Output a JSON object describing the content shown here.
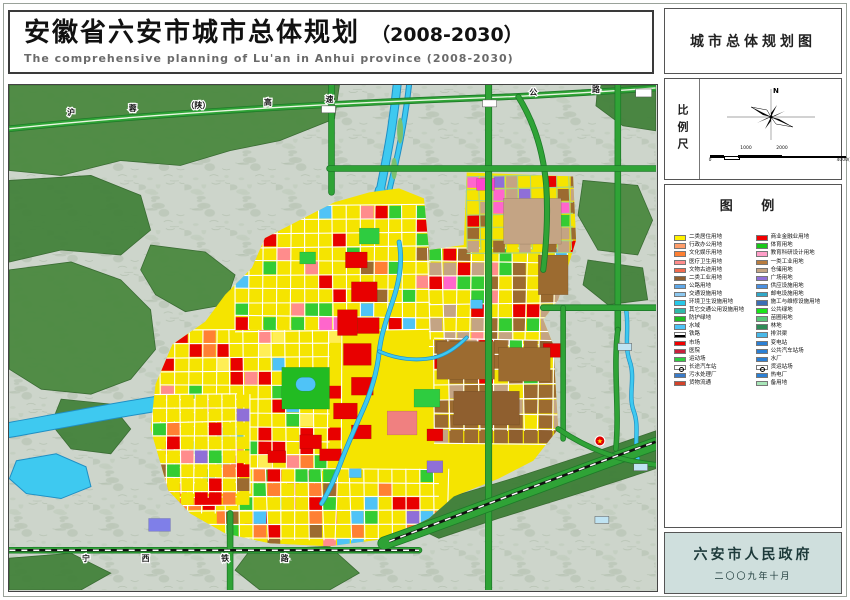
{
  "title": {
    "zh": "安徽省六安市城市总体规划",
    "year": "（2008-2030）",
    "en": "The comprehensive planning of Lu'an in Anhui province (2008-2030)"
  },
  "sidebar": {
    "map_title": "城市总体规划图",
    "scale_label": "比例尺",
    "north_label": "N",
    "legend_title": "图  例",
    "footer": {
      "org": "六安市人民政府",
      "date": "二〇〇九年十月"
    }
  },
  "scalebar": {
    "ticks": [
      {
        "label": "0",
        "pos": 0,
        "below": true
      },
      {
        "label": "1000",
        "pos": 36,
        "below": false
      },
      {
        "label": "2000",
        "pos": 72,
        "below": false
      },
      {
        "label": "4000(M)",
        "pos": 136,
        "below": true
      }
    ]
  },
  "legend": {
    "left": [
      {
        "label": "二类居住用地",
        "color": "#FFF200"
      },
      {
        "label": "行政办公用地",
        "color": "#FF9E6B"
      },
      {
        "label": "文化娱乐用地",
        "color": "#FF8033"
      },
      {
        "label": "医疗卫生用地",
        "color": "#FF8C8C"
      },
      {
        "label": "文物古迹用地",
        "color": "#F26B4E"
      },
      {
        "label": "二类工业用地",
        "color": "#8F5F2F"
      },
      {
        "label": "公路用地",
        "color": "#5FA8E8"
      },
      {
        "label": "交通设施用地",
        "color": "#8CC8F0"
      },
      {
        "label": "环境卫生设施用地",
        "color": "#28C8E8"
      },
      {
        "label": "其它交通公用设施用地",
        "color": "#30B8A8"
      },
      {
        "label": "防护绿地",
        "color": "#22BB22"
      },
      {
        "label": "水域",
        "color": "#4FC3F7"
      },
      {
        "label": "铁路",
        "color": "#FFFFFF",
        "type": "line"
      },
      {
        "label": "市场",
        "color": "#F20000"
      },
      {
        "label": "医院",
        "color": "#C81E3C"
      },
      {
        "label": "运动场",
        "color": "#2ECC40"
      },
      {
        "label": "长途汽车站",
        "color": "#FFFFFF",
        "type": "circle"
      },
      {
        "label": "污水处理厂",
        "color": "#3A7BC8"
      },
      {
        "label": "货物流通",
        "color": "#D2422A"
      }
    ],
    "right": [
      {
        "label": "商业金融业用地",
        "color": "#F20000"
      },
      {
        "label": "体育用地",
        "color": "#19C819"
      },
      {
        "label": "教育科研设计用地",
        "color": "#FF9EC8"
      },
      {
        "label": "一类工业用地",
        "color": "#B97C3E"
      },
      {
        "label": "仓储用地",
        "color": "#C4A484"
      },
      {
        "label": "广场用地",
        "color": "#8F6FD8"
      },
      {
        "label": "供应设施用地",
        "color": "#4A90E2"
      },
      {
        "label": "邮电设施用地",
        "color": "#30A8C8"
      },
      {
        "label": "施工与维修设施用地",
        "color": "#3C6EB4"
      },
      {
        "label": "公共绿地",
        "color": "#19E619"
      },
      {
        "label": "苗圃用地",
        "color": "#58C878"
      },
      {
        "label": "林地",
        "color": "#2E8B57"
      },
      {
        "label": "排洪渠",
        "color": "#49B8E8"
      },
      {
        "label": "变电站",
        "color": "#2B7FD4"
      },
      {
        "label": "公共汽车站场",
        "color": "#2B7FD4"
      },
      {
        "label": "水厂",
        "color": "#2B7FD4"
      },
      {
        "label": "货运站场",
        "color": "#FFFFFF",
        "type": "circle"
      },
      {
        "label": "热电厂",
        "color": "#2B7FD4"
      },
      {
        "label": "备用地",
        "color": "#A8E6B8"
      }
    ]
  },
  "map": {
    "bg": "#cdd5cb",
    "road_labels": [
      {
        "t": "沪",
        "x": 70,
        "y": 114
      },
      {
        "t": "蓉",
        "x": 132,
        "y": 110
      },
      {
        "t": "（陕）",
        "x": 198,
        "y": 107
      },
      {
        "t": "高",
        "x": 268,
        "y": 104
      },
      {
        "t": "速",
        "x": 330,
        "y": 101
      },
      {
        "t": "公",
        "x": 535,
        "y": 94
      },
      {
        "t": "路",
        "x": 598,
        "y": 91
      },
      {
        "t": "宁",
        "x": 85,
        "y": 563
      },
      {
        "t": "西",
        "x": 145,
        "y": 563
      },
      {
        "t": "铁",
        "x": 225,
        "y": 563
      },
      {
        "t": "路",
        "x": 285,
        "y": 563
      }
    ],
    "forests": [
      {
        "pts": "8,84 340,84 335,118 280,140 230,150 180,165 120,160 60,175 8,170",
        "fill": "#4c8a41"
      },
      {
        "pts": "8,180 90,175 140,195 150,230 120,255 60,250 8,262",
        "fill": "#45833d"
      },
      {
        "pts": "8,270 70,262 120,280 150,310 155,350 130,380 90,395 40,390 8,370",
        "fill": "#4c8a41"
      },
      {
        "pts": "60,400 110,405 130,430 110,455 70,450 50,425",
        "fill": "#45833d"
      },
      {
        "pts": "150,245 205,252 235,275 225,305 185,312 155,295 140,270",
        "fill": "#4c8a41"
      },
      {
        "pts": "600,84 658,84 658,130 625,125 598,105",
        "fill": "#45833d"
      },
      {
        "pts": "585,180 640,185 655,220 640,255 600,250 580,215",
        "fill": "#4c8a41"
      },
      {
        "pts": "590,260 645,268 650,300 610,305 585,285",
        "fill": "#45833d"
      },
      {
        "pts": "250,552 330,548 360,575 330,592 260,592 235,572",
        "fill": "#4c8a41"
      },
      {
        "pts": "430,505 520,478 600,452 658,432 658,470 590,492 500,520 440,540 415,528",
        "fill": "#3f7f38"
      },
      {
        "pts": "8,560 70,555 110,575 80,592 8,592",
        "fill": "#45833d"
      }
    ],
    "lakes": [
      {
        "pts": "15,462 55,455 85,468 90,488 60,500 25,495 8,480",
        "fill": "#3ec9f0"
      }
    ],
    "rivers": [
      {
        "d": "M398,84 C394,125 388,155 381,190",
        "w": 7
      },
      {
        "d": "M410,84 C406,120 400,150 392,182 C388,200 384,215 378,232",
        "w": 4
      },
      {
        "d": "M381,190 C374,226 366,254 350,287",
        "w": 9
      },
      {
        "d": "M350,287 C336,316 312,344 282,363",
        "w": 11
      },
      {
        "d": "M282,363 C248,386 198,398 148,406 C98,414 48,424 8,431",
        "w": 14
      }
    ],
    "islands": [
      {
        "cx": 401,
        "cy": 130,
        "rx": 3,
        "ry": 13
      },
      {
        "cx": 395,
        "cy": 168,
        "ry": 11,
        "rx": 3
      },
      {
        "cx": 387,
        "cy": 205,
        "rx": 3,
        "ry": 11
      }
    ],
    "city_rivers": [
      {
        "d": "M400,242 C404,262 400,282 394,300 C388,318 382,334 380,352 C378,372 372,392 364,410 C356,428 348,446 342,462 C336,478 330,492 322,505",
        "w": 3.5
      },
      {
        "d": "M380,352 C398,360 418,362 436,358 C448,355 458,348 468,338",
        "w": 2.5
      },
      {
        "d": "M628,308 C632,328 626,345 632,362 C638,379 630,396 636,412 C642,428 636,444 640,460",
        "w": 3
      }
    ],
    "urban": "150,430 155,385 172,345 205,322 225,295 252,268 265,238 300,220 335,202 370,192 400,188 425,198 430,250 465,245 468,172 575,176 578,240 560,300 545,320 555,345 560,430 535,462 500,480 455,498 430,520 390,540 330,548 270,545 225,535 190,515 168,492",
    "urban_fill": "#F5E400",
    "districts": [
      {
        "x": 160,
        "y": 330,
        "w": 170,
        "h": 185,
        "cell": 14,
        "seed": 11,
        "grid": "#ffffff",
        "palette": [
          [
            "#F5E400",
            60
          ],
          [
            "#E80000",
            11
          ],
          [
            "#33CC33",
            9
          ],
          [
            "#FF8033",
            5
          ],
          [
            "#FF8C8C",
            4
          ],
          [
            "#9C6B30",
            3
          ],
          [
            "#4FC3F7",
            2
          ],
          [
            "#8F6FD8",
            2
          ],
          [
            "#FFEE55",
            4
          ]
        ]
      },
      {
        "x": 235,
        "y": 205,
        "w": 195,
        "h": 125,
        "cell": 14,
        "seed": 22,
        "grid": "#ffffff",
        "palette": [
          [
            "#F5E400",
            58
          ],
          [
            "#33CC33",
            12
          ],
          [
            "#E80000",
            9
          ],
          [
            "#FF8C8C",
            5
          ],
          [
            "#FF66CC",
            4
          ],
          [
            "#4FC3F7",
            3
          ],
          [
            "#FF8033",
            4
          ],
          [
            "#9C6B30",
            5
          ]
        ]
      },
      {
        "x": 430,
        "y": 248,
        "w": 135,
        "h": 92,
        "cell": 14,
        "seed": 33,
        "grid": "#ffffff",
        "palette": [
          [
            "#F5E400",
            45
          ],
          [
            "#33CC33",
            13
          ],
          [
            "#E80000",
            7
          ],
          [
            "#FF8C8C",
            7
          ],
          [
            "#C4A484",
            12
          ],
          [
            "#9C6B30",
            10
          ],
          [
            "#FF66CC",
            3
          ],
          [
            "#4FC3F7",
            3
          ]
        ]
      },
      {
        "x": 468,
        "y": 175,
        "w": 107,
        "h": 75,
        "cell": 13,
        "seed": 44,
        "grid": "#a4d48a",
        "palette": [
          [
            "#F5E400",
            42
          ],
          [
            "#C4A484",
            20
          ],
          [
            "#9C6B30",
            14
          ],
          [
            "#E80000",
            7
          ],
          [
            "#FF66CC",
            5
          ],
          [
            "#33CC33",
            8
          ],
          [
            "#8F6FD8",
            4
          ]
        ]
      },
      {
        "x": 435,
        "y": 340,
        "w": 128,
        "h": 92,
        "cell": 15,
        "seed": 55,
        "grid": "#ffffff",
        "palette": [
          [
            "#9C6B30",
            48
          ],
          [
            "#C4A484",
            22
          ],
          [
            "#F5E400",
            12
          ],
          [
            "#E80000",
            6
          ],
          [
            "#33CC33",
            6
          ],
          [
            "#8F5F2F",
            6
          ]
        ]
      },
      {
        "x": 225,
        "y": 470,
        "w": 215,
        "h": 72,
        "cell": 14,
        "seed": 66,
        "grid": "#ffffff",
        "palette": [
          [
            "#F5E400",
            52
          ],
          [
            "#33CC33",
            10
          ],
          [
            "#E80000",
            10
          ],
          [
            "#9C6B30",
            6
          ],
          [
            "#FF8C8C",
            5
          ],
          [
            "#4FC3F7",
            4
          ],
          [
            "#8F6FD8",
            4
          ],
          [
            "#FF8033",
            9
          ]
        ]
      },
      {
        "x": 152,
        "y": 395,
        "w": 85,
        "h": 100,
        "cell": 14,
        "seed": 77,
        "grid": "#ffffff",
        "palette": [
          [
            "#F5E400",
            58
          ],
          [
            "#E80000",
            10
          ],
          [
            "#33CC33",
            10
          ],
          [
            "#8F6FD8",
            4
          ],
          [
            "#9C6B30",
            5
          ],
          [
            "#FF8033",
            8
          ],
          [
            "#FF8C8C",
            5
          ]
        ]
      }
    ],
    "features": [
      {
        "x": 282,
        "y": 368,
        "w": 48,
        "h": 42,
        "f": "#22BB22"
      },
      {
        "x": 296,
        "y": 378,
        "w": 20,
        "h": 14,
        "f": "#4FC3F7",
        "rx": 7
      },
      {
        "x": 388,
        "y": 412,
        "w": 30,
        "h": 24,
        "f": "#F08080"
      },
      {
        "x": 415,
        "y": 390,
        "w": 26,
        "h": 18,
        "f": "#2ECC40"
      },
      {
        "x": 478,
        "y": 178,
        "w": 18,
        "h": 12,
        "f": "#FF44CC"
      },
      {
        "x": 428,
        "y": 462,
        "w": 16,
        "h": 12,
        "f": "#8F6FD8"
      },
      {
        "x": 148,
        "y": 520,
        "w": 22,
        "h": 13,
        "f": "#7F7FE8"
      },
      {
        "x": 346,
        "y": 252,
        "w": 22,
        "h": 16,
        "f": "#E80000"
      },
      {
        "x": 352,
        "y": 282,
        "w": 26,
        "h": 20,
        "f": "#E80000"
      },
      {
        "x": 338,
        "y": 310,
        "w": 20,
        "h": 26,
        "f": "#E80000"
      },
      {
        "x": 358,
        "y": 318,
        "w": 22,
        "h": 16,
        "f": "#E80000"
      },
      {
        "x": 344,
        "y": 344,
        "w": 28,
        "h": 22,
        "f": "#E80000"
      },
      {
        "x": 352,
        "y": 378,
        "w": 22,
        "h": 18,
        "f": "#E80000"
      },
      {
        "x": 334,
        "y": 404,
        "w": 24,
        "h": 16,
        "f": "#E80000"
      },
      {
        "x": 352,
        "y": 426,
        "w": 20,
        "h": 14,
        "f": "#E80000"
      },
      {
        "x": 300,
        "y": 436,
        "w": 22,
        "h": 14,
        "f": "#E80000"
      },
      {
        "x": 268,
        "y": 452,
        "w": 18,
        "h": 12,
        "f": "#E80000"
      },
      {
        "x": 320,
        "y": 450,
        "w": 22,
        "h": 12,
        "f": "#E80000"
      },
      {
        "x": 545,
        "y": 344,
        "w": 18,
        "h": 14,
        "f": "#E80000"
      },
      {
        "x": 428,
        "y": 430,
        "w": 16,
        "h": 12,
        "f": "#E80000"
      },
      {
        "x": 360,
        "y": 228,
        "w": 20,
        "h": 16,
        "f": "#2ECC40"
      },
      {
        "x": 300,
        "y": 252,
        "w": 16,
        "h": 12,
        "f": "#2ECC40"
      },
      {
        "x": 505,
        "y": 198,
        "w": 58,
        "h": 46,
        "f": "#C4A484"
      },
      {
        "x": 540,
        "y": 255,
        "w": 30,
        "h": 40,
        "f": "#9C6B30"
      },
      {
        "x": 438,
        "y": 342,
        "w": 58,
        "h": 38,
        "f": "#9C6B30"
      },
      {
        "x": 500,
        "y": 348,
        "w": 52,
        "h": 34,
        "f": "#9C6B30"
      },
      {
        "x": 455,
        "y": 392,
        "w": 66,
        "h": 34,
        "f": "#8F5F2F"
      },
      {
        "x": 472,
        "y": 300,
        "w": 12,
        "h": 9,
        "f": "#4FC3F7"
      },
      {
        "x": 350,
        "y": 470,
        "w": 12,
        "h": 9,
        "f": "#4FC3F7"
      }
    ],
    "roads": [
      {
        "d": "M8,128 C150,113 320,103 480,97 C540,95 600,91 658,87",
        "w": 5,
        "type": "expressway"
      },
      {
        "d": "M520,96 C535,120 545,150 548,185 C550,215 548,245 545,270",
        "w": 4.5
      },
      {
        "d": "M332,84 L332,192",
        "w": 5
      },
      {
        "d": "M490,84 L490,592",
        "w": 5.5
      },
      {
        "d": "M620,84 L620,330",
        "w": 5
      },
      {
        "d": "M620,330 C615,370 622,410 618,450",
        "w": 4
      },
      {
        "d": "M330,168 L658,168",
        "w": 5
      },
      {
        "d": "M545,308 L658,308",
        "w": 5
      },
      {
        "d": "M565,308 L565,440",
        "w": 4
      },
      {
        "d": "M8,552 L420,552",
        "w": 5
      },
      {
        "d": "M230,515 L230,592",
        "w": 5
      },
      {
        "d": "M385,545 C470,515 560,480 658,445",
        "w": 12
      },
      {
        "d": "M560,430 C590,450 620,462 658,466",
        "w": 4
      }
    ],
    "railways": [
      {
        "d": "M8,552 L420,552"
      },
      {
        "d": "M390,543 C470,513 560,478 658,443"
      }
    ],
    "marker": {
      "x": 602,
      "y": 442,
      "star": "★"
    },
    "small_boxes": [
      {
        "x": 638,
        "y": 88,
        "w": 16,
        "h": 8,
        "f": "#ffffff"
      },
      {
        "x": 620,
        "y": 344,
        "w": 14,
        "h": 7,
        "f": "#bfe3f2"
      },
      {
        "x": 636,
        "y": 465,
        "w": 14,
        "h": 7,
        "f": "#bfe3f2"
      },
      {
        "x": 322,
        "y": 105,
        "w": 14,
        "h": 7,
        "f": "#ffffff"
      },
      {
        "x": 484,
        "y": 99,
        "w": 14,
        "h": 7,
        "f": "#ffffff"
      },
      {
        "x": 597,
        "y": 518,
        "w": 14,
        "h": 7,
        "f": "#bfe3f2"
      }
    ]
  }
}
